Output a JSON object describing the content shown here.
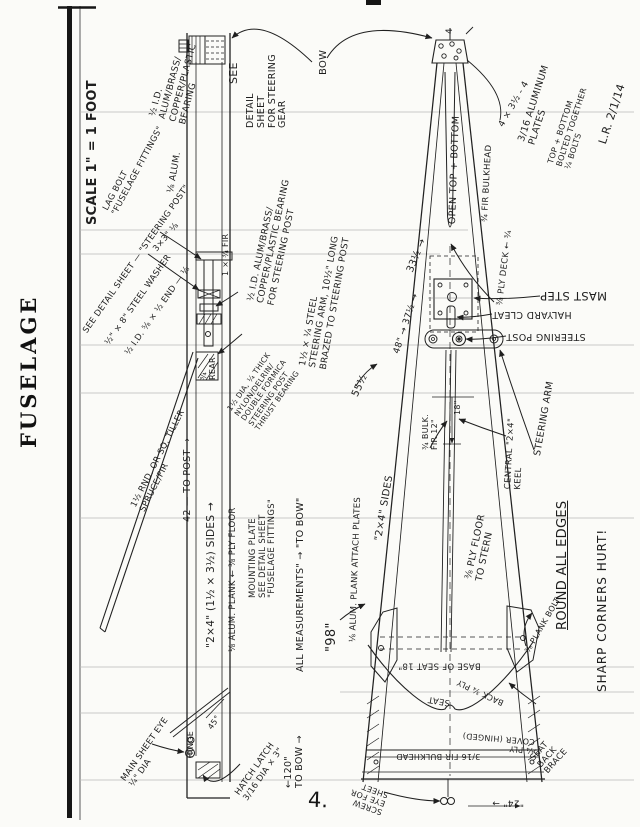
{
  "page": {
    "title": "FUSELAGE",
    "page_number": "4.",
    "signature": "L.R. 2/1/14"
  },
  "annotations": {
    "scale": "SCALE 1\" = 1 FOOT",
    "lag_bolt": "LAG BOLT\n\"FUSELAGE FITTINGS\"",
    "bearing_top": "½ I.D.\nALUM/BRASS/\nCOPPER/PLASTIC\nBEARING",
    "alum_18": "⅛ ALUM.",
    "see": "SEE",
    "detail_steering_gear": "DETAIL\nSHEET\nFOR STEERING\nGEAR",
    "bow": "BOW",
    "see_detail_steering_post": "SEE DETAIL SHEET — \"STEERING POST\"",
    "steel_washer": "½\" × 8\" STEEL WASHER",
    "steel_end": "½ I.D. ⅝ × ½ END — ⅛",
    "three_by_three": "3×3\" ⅛",
    "fir_134": "1 × ¾ FIR",
    "bearing_mid": "½ I.D. ALUM/BRASS/\nCOPPER/PLASTIC BEARING\nFOR STEERING POST",
    "steering_arm_steel": "1½ × ¼ STEEL\nSTEERING ARM, 10½\" LONG\nBRAZED TO STEERING POST",
    "thrust_bearing": "1½ DIA, ¼ THICK\nNYLON/DELRIN/\nDOUBLE FORMICA\nSTEERING POST\nTHRUST BEARING",
    "rear_34": "¾\nREAR",
    "tiller": "1½ RND. OR SQ. TILLER\nSPRUCE/FIR",
    "to_post_42": "42 — TO POST →",
    "sides_2x4": "\"2×4\" (1½ × 3½) SIDES →",
    "ply_floor_38": "⅛ ALUM. PLANK ← ⅜ PLY FLOOR",
    "mounting_plate": "MOUNTING PLATE\nSEE DETAIL SHEET\n\"FUSELAGE FITTINGS\"",
    "all_measurements": "ALL MEASUREMENTS\" → \"TO BOW\"",
    "main_sheet_eye": "MAIN SHEET EYE\n¼\" DIA",
    "hinge": "HINGE",
    "deg45": "45°",
    "hatch_latch": "HATCH LATCH\n3/16 DIA × 3\"",
    "to_bow_120": "←120\"\nTO BOW →",
    "tip4": "4",
    "open_top": "OPEN TOP + BOTTOM",
    "fir_bulkhead_34top": "¾ FIR BULKHEAD",
    "dim_4x35": "4 × 3½ - 4",
    "alum_plates": "3/16 ALUMINUM\nPLATES",
    "bolted": "TOP + BOTTOM\nBOLTED TOGETHER\n¼ BOLTS",
    "initials": "L.R. 2/1/14",
    "dim_33": "33½ →",
    "dim_48_37": "48\" → 37½ →",
    "dim_55": "55½",
    "ply_deck": "⅜ PLY DECK ← ¾",
    "mast_step": "MAST STEP",
    "halyard_cleat": "HALYARD CLEAT",
    "steering_post": "STEERING POST",
    "steering_arm": "STEERING ARM",
    "bulk_fir": "¾ BULK.\nFIR 12\"",
    "dim_18": "18\"",
    "central_keel": "CENTRAL \"2×4\"\nKEEL",
    "sides_2x4b": "\"2×4\" SIDES",
    "ply_floor_stern": "⅜ PLY FLOOR\nTO STERN",
    "attach_plates": "⅛ ALUM. PLANK ATTACH PLATES",
    "dim_98": "\"98\"",
    "round_all": "ROUND ALL EDGES",
    "sharp": "SHARP CORNERS HURT!",
    "plank_bolt": "⅜ PLANK BOLT",
    "seat_back_brace": "SEAT\nBACK\nBRACE",
    "base_of_seat": "BASE OF SEAT 18\"",
    "seat": "SEAT",
    "back_ply": "BACK ¾ PLY",
    "fir_bulkhead_316": "3/16 FIR BULKHEAD",
    "ply_cover": "¼ PLY\nCOVER (HINGED)",
    "screw_eye": "SCREW\nEYE FOR\nSHEET",
    "dim_24": "\"24\" →"
  }
}
